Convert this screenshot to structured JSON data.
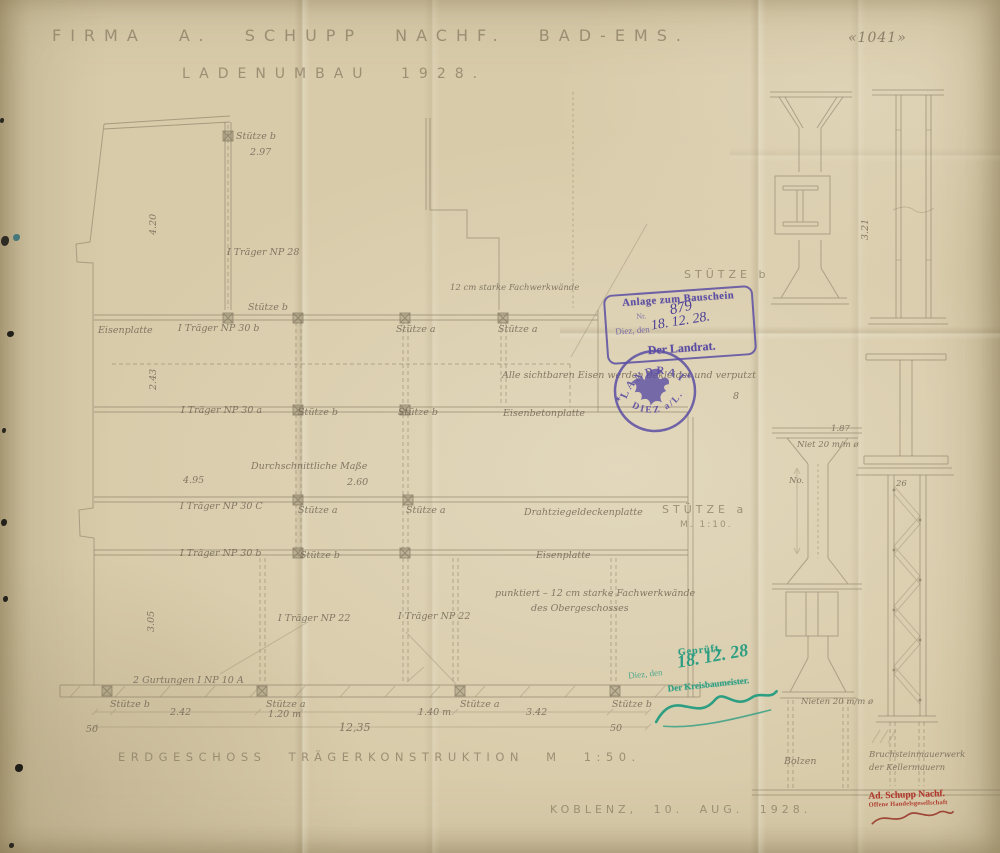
{
  "header": {
    "title_line1": "FIRMA A. SCHUPP NACHF. BAD-EMS.",
    "title_line2": "LADENUMBAU 1928.",
    "sheet_number": "«1041»"
  },
  "footer": {
    "caption": "ERDGESCHOSS TRÄGERKONSTRUKTION M 1:50.",
    "place_date": "KOBLENZ, 10. AUG. 1928."
  },
  "plan": {
    "labels": {
      "stuetze_a": "Stütze a",
      "stuetze_b": "Stütze b",
      "traeger_np28": "I Träger NP 28",
      "traeger_np30a": "I Träger NP 30 a",
      "traeger_np30b": "I Träger NP 30 b",
      "traeger_np30c": "I Träger NP 30 C",
      "traeger_np22": "I Träger NP 22",
      "gurtungen": "2 Gurtungen I NP 10 A",
      "eisenplatte": "Eisenplatte",
      "eisenbetonplatte": "Eisenbetonplatte",
      "deckenplatte": "Drahtziegeldeckenplatte",
      "durchschnitt": "Durchschnittliche Maße",
      "durchschnitt_wert": "2.60"
    },
    "dims": {
      "d297": "2.97",
      "d420": "4.20",
      "d243": "2.43",
      "d495": "4.95",
      "d305": "3.05",
      "d242": "2.42",
      "d120": "1.20 m",
      "d140": "1.40 m",
      "d342": "3.42",
      "d50": "50",
      "total": "12,35"
    },
    "notes": {
      "fachwerk": "12 cm starke Fachwerkwände",
      "eisen_verputzt": "Alle sichtbaren Eisen werden bekleidet und verputzt",
      "acht": "8",
      "punktiert1": "punktiert – 12 cm starke Fachwerkwände",
      "punktiert2": "des Obergeschosses"
    }
  },
  "details": {
    "stuetze_b_title": "STÜTZE b",
    "stuetze_a_title": "STÜTZE a",
    "massstab": "M. 1:10.",
    "dims": {
      "d321": "3.21",
      "d187": "1.87",
      "d26": "26",
      "no": "No."
    },
    "notes": {
      "niet": "Niet 20 m/m ø",
      "nieten": "Nieten 20 m/m ø",
      "bolzen": "Bolzen",
      "bruchstein1": "Bruchsteinmauerwerk",
      "bruchstein2": "der Kellermauern"
    }
  },
  "stamps": {
    "bauschein": {
      "line1": "Anlage zum Bauschein",
      "nr_label": "Nr.",
      "nr_value": "879",
      "ort_label": "Diez, den",
      "datum": "18. 12. 28.",
      "line4": "Der Landrat."
    },
    "landrat": {
      "arc_top": "LANDRAT",
      "arc_bottom": "DIEZ a/L.",
      "star": "✶"
    },
    "geprueft": {
      "line1": "Geprüft.",
      "ort": "Diez, den",
      "datum": "18. 12. 28",
      "amt": "Der Kreisbaumeister."
    },
    "firma": {
      "line1": "Ad. Schupp Nachf.",
      "line2": "Offene Handelsgesellschaft"
    }
  },
  "colors": {
    "paper": "#d8cbaa",
    "pencil": "#857962",
    "stamp_purple": "#5b4da3",
    "stamp_green": "#2e9e82",
    "stamp_red": "#b03a2e"
  }
}
